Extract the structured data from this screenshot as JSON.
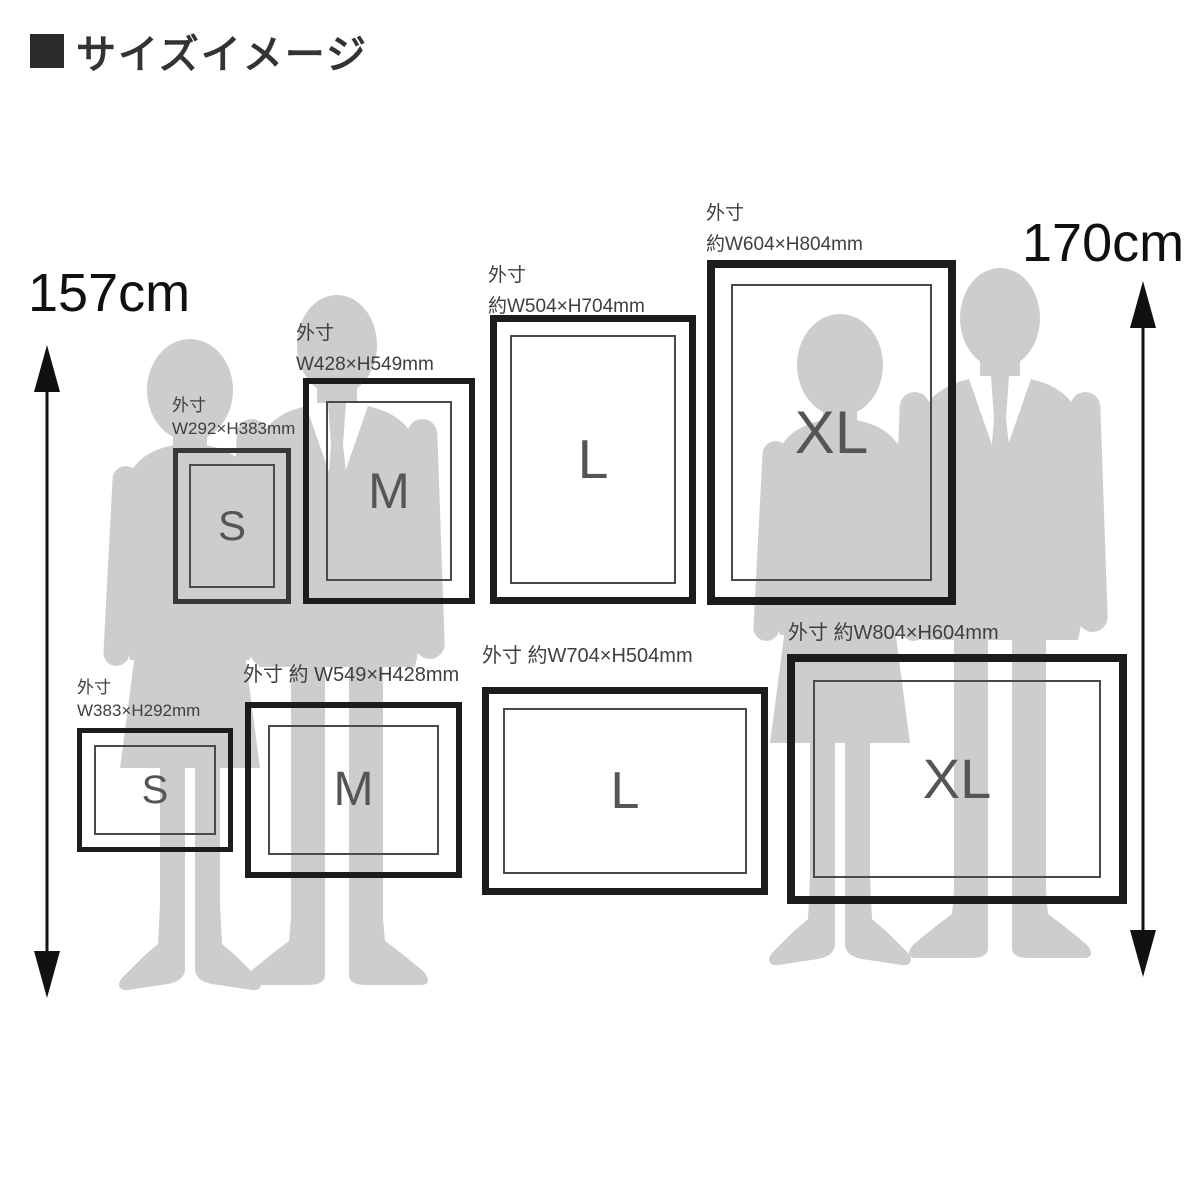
{
  "title": "サイズイメージ",
  "height_scale": {
    "left_label": "157cm",
    "right_label": "170cm"
  },
  "portrait_frames": [
    {
      "size": "S",
      "label_line1": "外寸",
      "label_line2": "W292×H383mm"
    },
    {
      "size": "M",
      "label_line1": "外寸",
      "label_line2": "W428×H549mm"
    },
    {
      "size": "L",
      "label_line1": "外寸",
      "label_line2": "約W504×H704mm"
    },
    {
      "size": "XL",
      "label_line1": "外寸",
      "label_line2": "約W604×H804mm"
    }
  ],
  "landscape_frames": [
    {
      "size": "S",
      "label_line1": "外寸",
      "label_line2": "W383×H292mm"
    },
    {
      "size": "M",
      "label_line1": "外寸 約 W549×H428mm",
      "label_line2": ""
    },
    {
      "size": "L",
      "label_line1": "外寸 約W704×H504mm",
      "label_line2": ""
    },
    {
      "size": "XL",
      "label_line1": "外寸 約W804×H604mm",
      "label_line2": ""
    }
  ],
  "colors": {
    "silhouette": "#cdcdcd",
    "frame_border": "#1c1c1c",
    "inner_border": "#4a4a4a",
    "size_letter": "#555555",
    "label_text": "#3f3f3f",
    "arrow": "#111111"
  }
}
